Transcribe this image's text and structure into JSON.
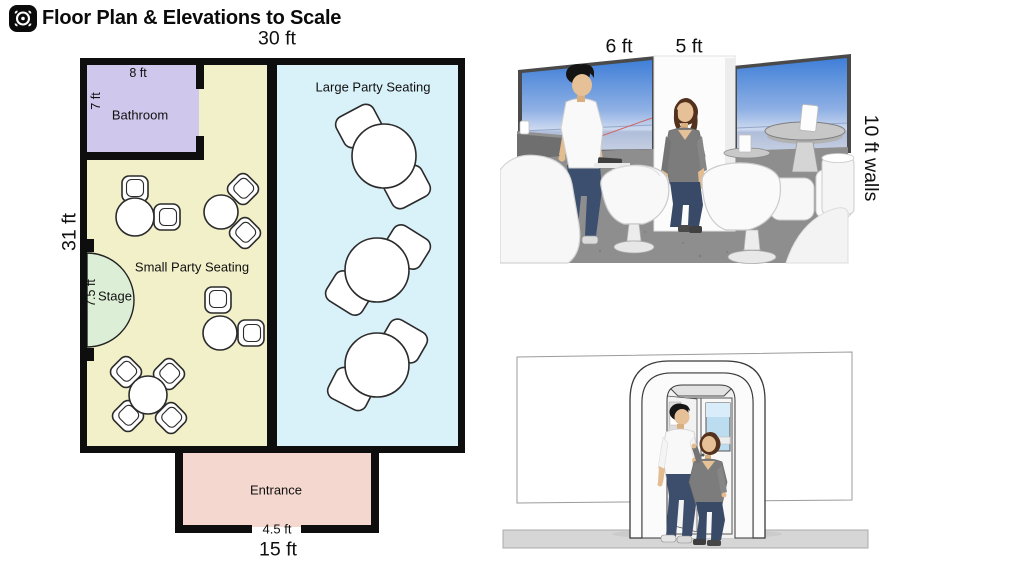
{
  "header": {
    "app_icon": "scan-target-icon",
    "title": "Floor Plan & Elevations to Scale"
  },
  "floor_plan": {
    "width_label": "30 ft",
    "height_label": "31 ft",
    "entrance_width_label": "15 ft",
    "bathroom": {
      "label": "Bathroom",
      "width_label": "8 ft",
      "depth_label": "7 ft"
    },
    "small_party": {
      "label": "Small Party Seating"
    },
    "large_party": {
      "label": "Large Party Seating"
    },
    "stage": {
      "label": "Stage",
      "width_label": "7.5 ft"
    },
    "entrance": {
      "label": "Entrance",
      "door_label": "4.5 ft"
    },
    "furniture": {
      "small_tables": 4,
      "small_table_chairs": 10,
      "large_tables": 3,
      "large_table_chairs": 6
    },
    "colors": {
      "wall": "#0e0e0e",
      "bathroom": "#cfc7ec",
      "small_party": "#f2f0c8",
      "large_party": "#d9f1f8",
      "stage": "#dcefd6",
      "entrance": "#f4d7cf"
    }
  },
  "elevations": {
    "interior_view": {
      "man_height_label": "6 ft",
      "woman_height_label": "5 ft",
      "wall_height_label": "10 ft walls"
    },
    "entrance_view": {}
  }
}
